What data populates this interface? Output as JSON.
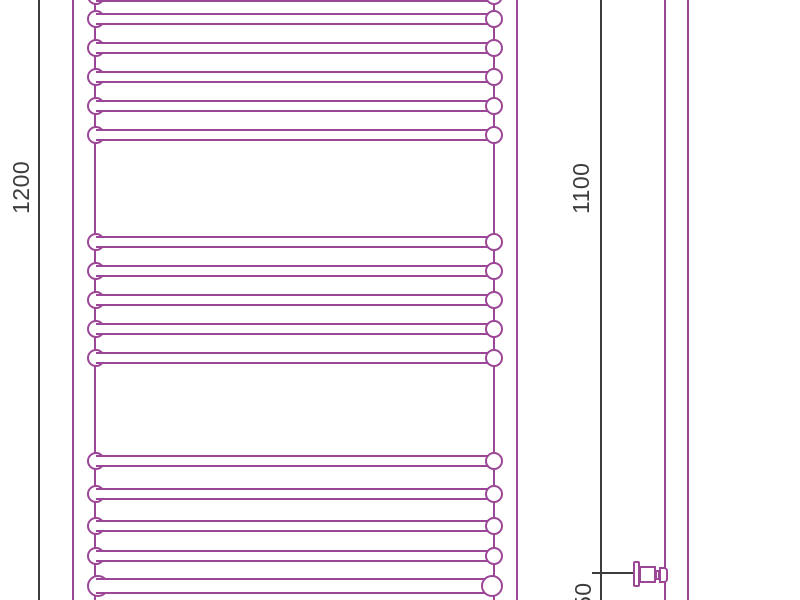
{
  "title": "Heated towel rail — dimensional drawing",
  "colors": {
    "outline": "#9b4696",
    "dimension": "#3c3c3c",
    "background": "#ffffff"
  },
  "labels": {
    "height": "1200",
    "connection_height": "1100",
    "bottom_offset": "50"
  },
  "drawing": {
    "front_view": {
      "post_lines_x": [
        72,
        94,
        493,
        516
      ],
      "rung_left_x": 87,
      "rung_width": 416,
      "rungs_standard_y": [
        -13,
        10,
        39,
        68,
        97,
        126,
        233,
        262,
        291,
        320,
        349,
        452,
        485,
        517,
        547
      ],
      "rungs_large_y": [
        575
      ]
    },
    "side_view": {
      "tube_lines_x": [
        664,
        687
      ]
    },
    "dimension_lines": {
      "left_x": 38,
      "right_x": 600,
      "tick": {
        "x": 592,
        "y": 572,
        "width": 42
      }
    },
    "valve": {
      "center_y": 574
    }
  }
}
